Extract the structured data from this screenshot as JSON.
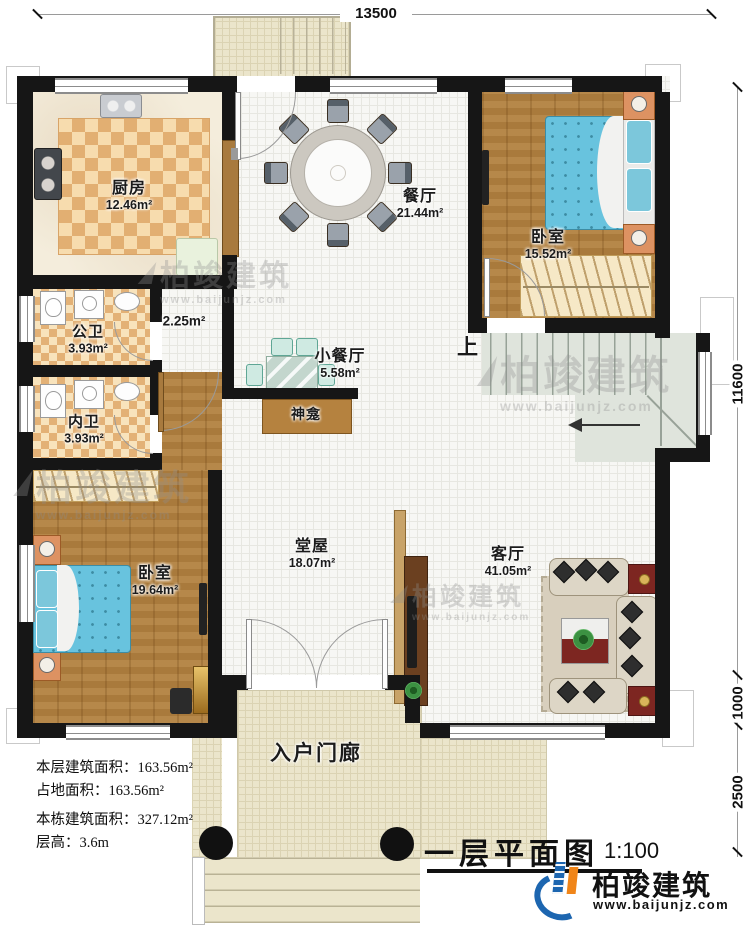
{
  "plan": {
    "dim_top": "13500",
    "dim_right_main": "11600",
    "dim_right_porch": "1000",
    "dim_right_steps": "2500",
    "stairs_up": "上"
  },
  "rooms": {
    "kitchen": {
      "name": "厨房",
      "area": "12.46m²"
    },
    "dining": {
      "name": "餐厅",
      "area": "21.44m²"
    },
    "bedroom_top": {
      "name": "卧室",
      "area": "15.52m²"
    },
    "public_bath": {
      "name": "公卫",
      "area": "3.93m²"
    },
    "closet": {
      "area": "2.25m²"
    },
    "private_bath": {
      "name": "内卫",
      "area": "3.93m²"
    },
    "small_dining": {
      "name": "小餐厅",
      "area": "5.58m²"
    },
    "shrine": {
      "name": "神龛"
    },
    "hall": {
      "name": "堂屋",
      "area": "18.07m²"
    },
    "living": {
      "name": "客厅",
      "area": "41.05m²"
    },
    "bedroom_bottom": {
      "name": "卧室",
      "area": "19.64m²"
    },
    "porch": {
      "name": "入户门廊"
    }
  },
  "info": {
    "floor_area": "本层建筑面积：163.56m²",
    "land_area": "占地面积：163.56m²",
    "total_area": "本栋建筑面积：327.12m²",
    "floor_height": "层高：3.6m"
  },
  "titleblock": {
    "title": "一层平面图",
    "scale": "1:100",
    "brand": "柏竣建筑",
    "website": "www.baijunjz.com"
  },
  "watermark": {
    "brand": "柏竣建筑",
    "website": "www.baijunjz.com"
  }
}
